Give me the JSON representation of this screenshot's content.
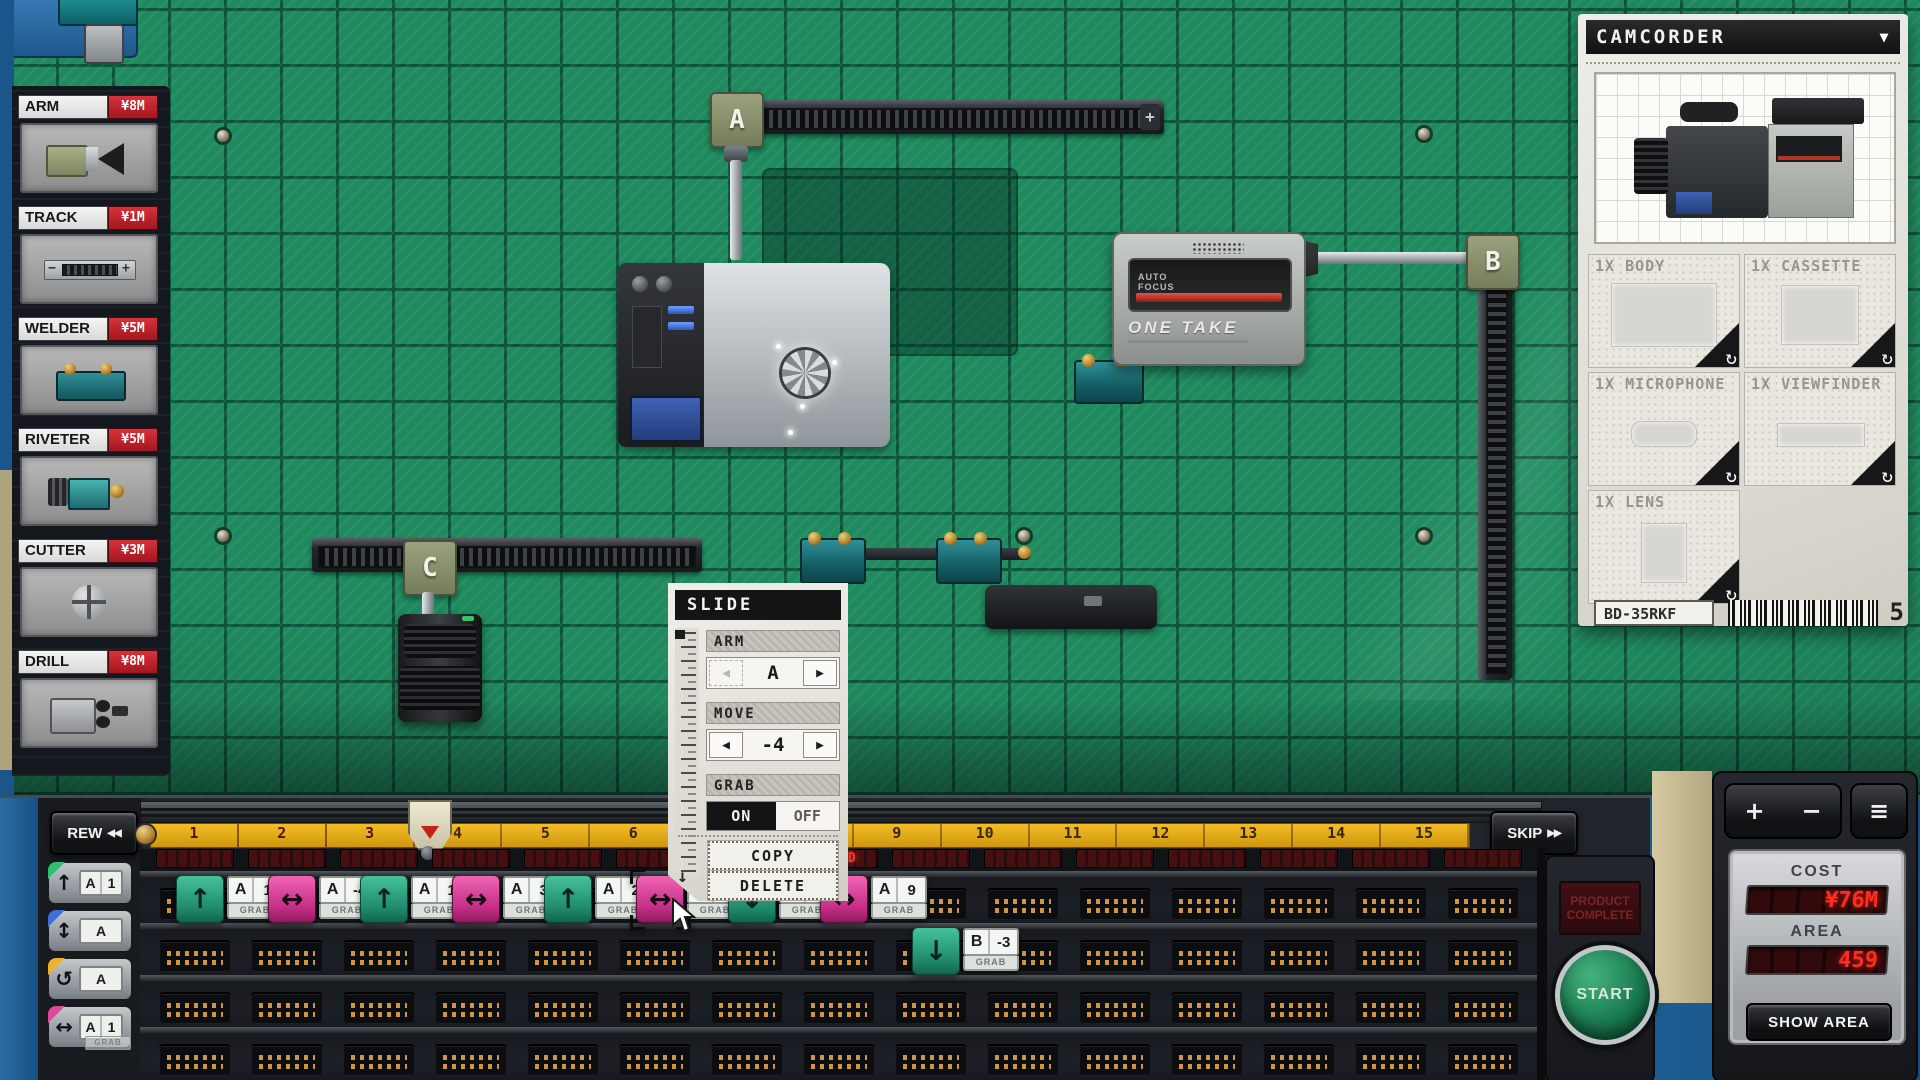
{
  "sidebar": {
    "items": [
      {
        "name": "ARM",
        "price": "¥8M"
      },
      {
        "name": "TRACK",
        "price": "¥1M"
      },
      {
        "name": "WELDER",
        "price": "¥5M"
      },
      {
        "name": "RIVETER",
        "price": "¥5M"
      },
      {
        "name": "CUTTER",
        "price": "¥3M"
      },
      {
        "name": "DRILL",
        "price": "¥8M"
      }
    ]
  },
  "board": {
    "arm_a": "A",
    "arm_b": "B",
    "arm_c": "C",
    "track_plus": "+",
    "cassette_machine": {
      "af_line1": "AUTO",
      "af_line2": "FOCUS",
      "brand": "ONE TAKE"
    }
  },
  "product_panel": {
    "title": "CAMCORDER",
    "dropdown_icon": "▼",
    "parts": [
      {
        "label": "1X BODY"
      },
      {
        "label": "1X CASSETTE"
      },
      {
        "label": "1X MICROPHONE"
      },
      {
        "label": "1X VIEWFINDER"
      },
      {
        "label": "1X LENS"
      }
    ],
    "rotate_icon": "↻",
    "model_code": "BD-35RKF",
    "quantity": "5"
  },
  "dialog": {
    "title": "SLIDE",
    "arm_label": "ARM",
    "arm_value": "A",
    "move_label": "MOVE",
    "move_value": "-4",
    "grab_label": "GRAB",
    "grab_on": "ON",
    "grab_off": "OFF",
    "copy": "COPY",
    "delete": "DELETE",
    "left_icon": "◀",
    "right_icon": "▶",
    "down_icon": "↓"
  },
  "timeline": {
    "rew": "REW",
    "rew_icon": "◀◀",
    "skip": "SKIP",
    "skip_icon": "▶▶",
    "ruler": [
      "1",
      "2",
      "3",
      "4",
      "5",
      "6",
      "7",
      "8",
      "9",
      "10",
      "11",
      "12",
      "13",
      "14",
      "15"
    ],
    "played_segments": 3,
    "led": {
      "slot": 8,
      "text": "WELD"
    },
    "palette": [
      {
        "arrow": "↑",
        "letter": "A",
        "value": "1",
        "grab": "",
        "corner": "#2fbf71"
      },
      {
        "arrow": "↕",
        "letter": "A",
        "value": "",
        "grab": "",
        "corner": "#3f6ed8"
      },
      {
        "arrow": "↺",
        "letter": "A",
        "value": "",
        "grab": "",
        "corner": "#efb32a"
      },
      {
        "arrow": "↔",
        "letter": "A",
        "value": "1",
        "grab": "GRAB",
        "corner": "#e0479e"
      }
    ],
    "chips": [
      {
        "row": 1,
        "slot": 1,
        "color": "teal",
        "arrow": "↑",
        "letter": "A",
        "value": "1",
        "grab": "GRAB"
      },
      {
        "row": 1,
        "slot": 2,
        "color": "pink",
        "arrow": "↔",
        "letter": "A",
        "value": "-4",
        "grab": "GRAB"
      },
      {
        "row": 1,
        "slot": 3,
        "color": "teal",
        "arrow": "↑",
        "letter": "A",
        "value": "1",
        "grab": "GRAB"
      },
      {
        "row": 1,
        "slot": 4,
        "color": "pink",
        "arrow": "↔",
        "letter": "A",
        "value": "3",
        "grab": "GRAB"
      },
      {
        "row": 1,
        "slot": 5,
        "color": "teal",
        "arrow": "↑",
        "letter": "A",
        "value": "2",
        "grab": "GRAB"
      },
      {
        "row": 1,
        "slot": 6,
        "color": "pink",
        "arrow": "↔",
        "letter": "A",
        "value": "-4",
        "grab": "GRAB",
        "selected": true
      },
      {
        "row": 1,
        "slot": 7,
        "color": "teal",
        "arrow": "↓",
        "letter": "",
        "value": "",
        "grab": "GRAB"
      },
      {
        "row": 1,
        "slot": 8,
        "color": "pink",
        "arrow": "↔",
        "letter": "A",
        "value": "9",
        "grab": "GRAB"
      },
      {
        "row": 2,
        "slot": 9,
        "color": "teal",
        "arrow": "↓",
        "letter": "B",
        "value": "-3",
        "grab": "GRAB"
      }
    ]
  },
  "console": {
    "product_sign": "PRODUCT COMPLETE",
    "start": "START",
    "zoom_in": "+",
    "zoom_out": "−",
    "menu_icon": "≡",
    "cost_label": "COST",
    "cost_value": "¥76M",
    "area_label": "AREA",
    "area_value": "459",
    "show_area": "SHOW AREA"
  }
}
